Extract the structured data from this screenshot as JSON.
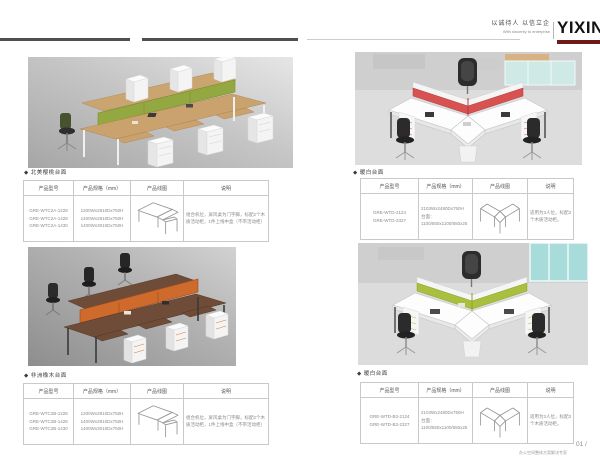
{
  "header": {
    "slogan_cn": "以诚待人 以信立企",
    "slogan_en": "With sincerity to enterprise",
    "logo_text": "YIXIN"
  },
  "footer": {
    "page_number": "01 /",
    "tagline": "办公空间整体方案解决专家"
  },
  "tables": {
    "columns": [
      "产品型号",
      "产品规格（mm）",
      "产品线图",
      "说明"
    ]
  },
  "sections": [
    {
      "caption": "◆ 北美樱桃台面",
      "models": [
        "GRE-WTC2A-1228",
        "GRE-WTC2A-1428",
        "GRE-WTC2A-1430"
      ],
      "specs": [
        "1200Wx2810Dx750H",
        "1400Wx2810Dx750H",
        "1400Wx3010Dx750H"
      ],
      "description": "组合机位，屏风桌为门字脚，标配2个木质活动柜，1件上线中盒（不带活动柜）"
    },
    {
      "caption": "◆ 非洲橡木台面",
      "models": [
        "GRE-WTC2B-1228",
        "GRE-WTC2B-1428",
        "GRE-WTC2B-1430"
      ],
      "specs": [
        "1200Wx2810Dx750H",
        "1400Wx2810Dx750H",
        "1400Wx3010Dx750H"
      ],
      "description": "组合机位，屏风桌为门字脚，标配2个木质活动柜，1件上线中盒（不带活动柜）"
    },
    {
      "caption": "◆ 暖白台面",
      "models": [
        "GRE-WTD-2124",
        "GRE-WTD-2327"
      ],
      "specs": [
        "2103Wx2480Dx750H",
        "台面：",
        "1100/550x1100/550x25"
      ],
      "description": "适用为3人位，标配3个木质活动柜。"
    },
    {
      "caption": "◆ 暖白台面",
      "models": [
        "GRE-WTD-B3-2124",
        "GRE-WTD-B3-2327"
      ],
      "specs": [
        "2103Wx2480Dx750H",
        "台面：",
        "1100/550x1100/550x25"
      ],
      "description": "适用为3人位，标配3个木质活动柜。"
    }
  ],
  "colors": {
    "rule_dark": "#4f4f4f",
    "logo_underline": "#6e1a1a",
    "screen_green": "#93a840",
    "screen_orange": "#c96a2e",
    "screen_red": "#d85252",
    "screen_lime": "#a9bf3e",
    "desk_beech": "#c9a26d",
    "desk_walnut": "#6f4c38",
    "desk_white": "#fdfdfd"
  }
}
